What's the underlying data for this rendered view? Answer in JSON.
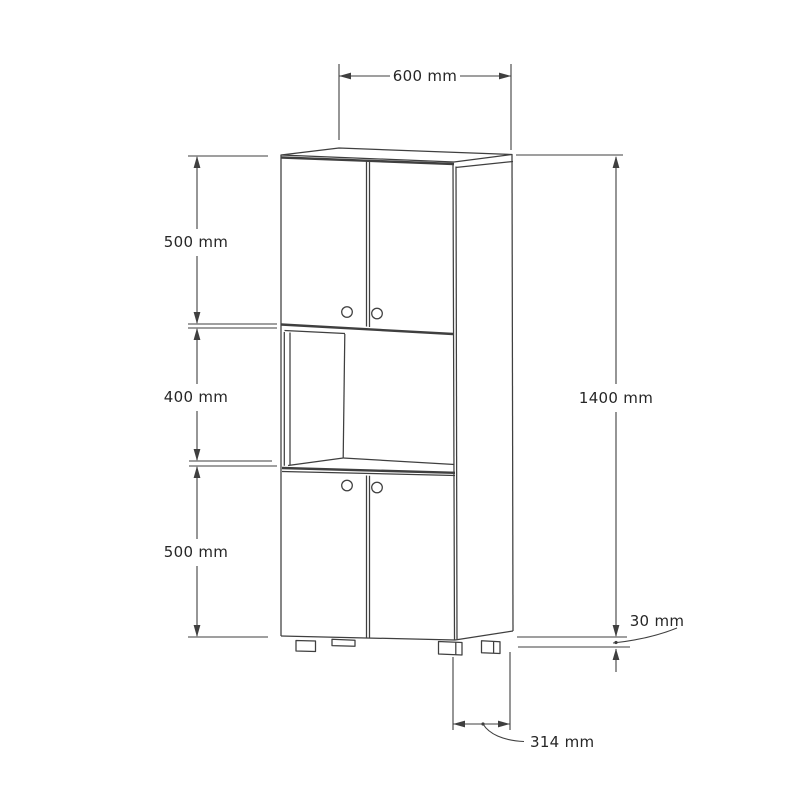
{
  "drawing": {
    "background_color": "#ffffff",
    "line_color": "#3f3f3f",
    "text_color": "#262626",
    "labels": {
      "top_width": "600 mm",
      "upper_section_height": "500 mm",
      "middle_section_height": "400 mm",
      "lower_section_height": "500 mm",
      "total_height": "1400 mm",
      "plinth_height": "30 mm",
      "depth": "314 mm"
    }
  }
}
